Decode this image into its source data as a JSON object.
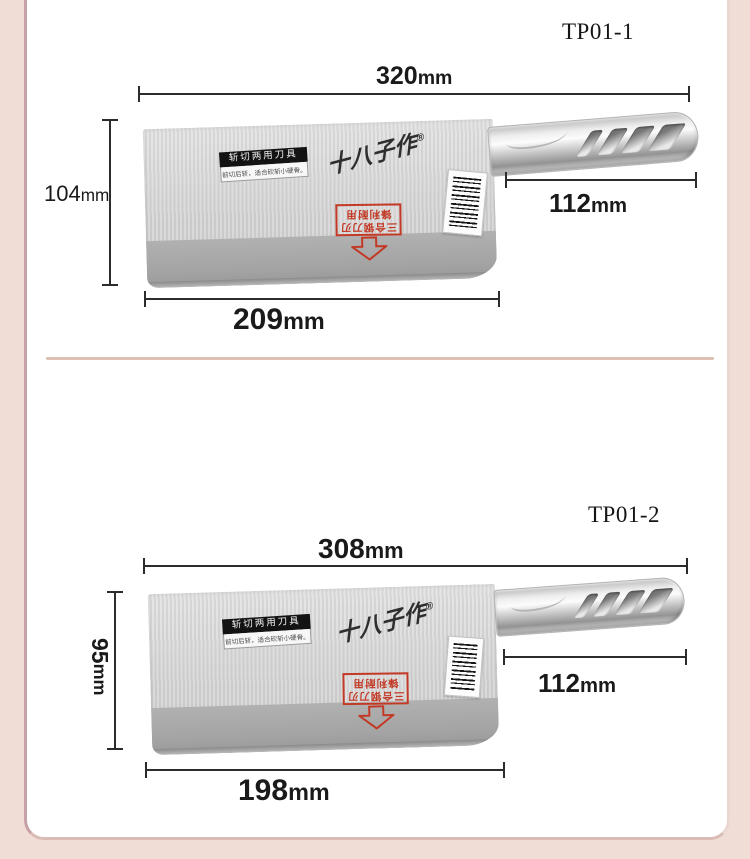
{
  "colors": {
    "page_bg": "#f0ddd5",
    "card_bg": "#ffffff",
    "dimension_line": "#2c2c2c",
    "divider": "#dcc0b2",
    "stamp_red": "#c23a26",
    "tag_bg": "#131313"
  },
  "knife": {
    "brand": "十八子作",
    "brand_reg": "®",
    "tag_title": "斩切两用刀具",
    "tag_sub": "前切后斩，适合砍斩小硬骨。",
    "stamp_line1": "三合钢刀刃",
    "stamp_line2": "锋利耐用"
  },
  "sections": [
    {
      "id": "TP01-1",
      "total": {
        "value": "320",
        "unit": "mm"
      },
      "height": {
        "value": "104",
        "unit": "mm"
      },
      "handle": {
        "value": "112",
        "unit": "mm"
      },
      "blade": {
        "value": "209",
        "unit": "mm"
      }
    },
    {
      "id": "TP01-2",
      "total": {
        "value": "308",
        "unit": "mm"
      },
      "height": {
        "value": "95",
        "unit": "mm"
      },
      "handle": {
        "value": "112",
        "unit": "mm"
      },
      "blade": {
        "value": "198",
        "unit": "mm"
      }
    }
  ]
}
